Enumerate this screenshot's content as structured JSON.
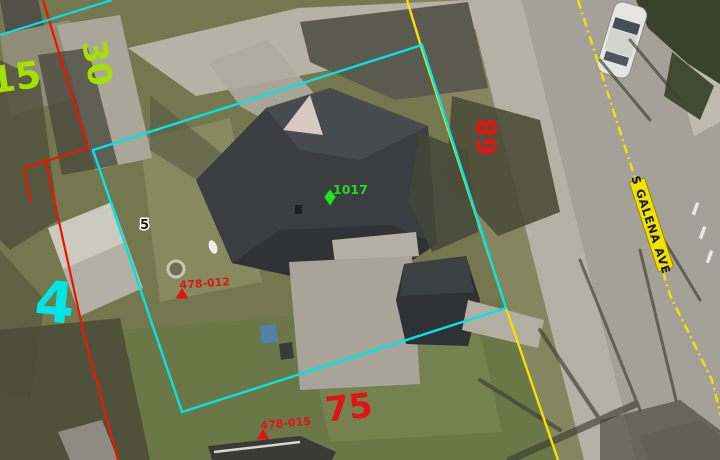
{
  "map": {
    "road": {
      "name": "S GALENA AVE"
    },
    "lot_numbers": {
      "green_15": "15",
      "green_30": "30",
      "cyan_4": "4",
      "red_68": "68",
      "red_75": "75"
    },
    "address_point": {
      "number": "1017"
    },
    "point_5": {
      "number": "5"
    },
    "survey_markers": {
      "marker_1": "478-012",
      "marker_2": "478-015"
    },
    "colors": {
      "cyan": "#00e5e5",
      "red": "#ee1400",
      "red_label": "#e01414",
      "green_yellow": "#a6e000",
      "address_green": "#28d428",
      "road_yellow": "#f2e204",
      "label_black": "#1a1a10"
    }
  }
}
